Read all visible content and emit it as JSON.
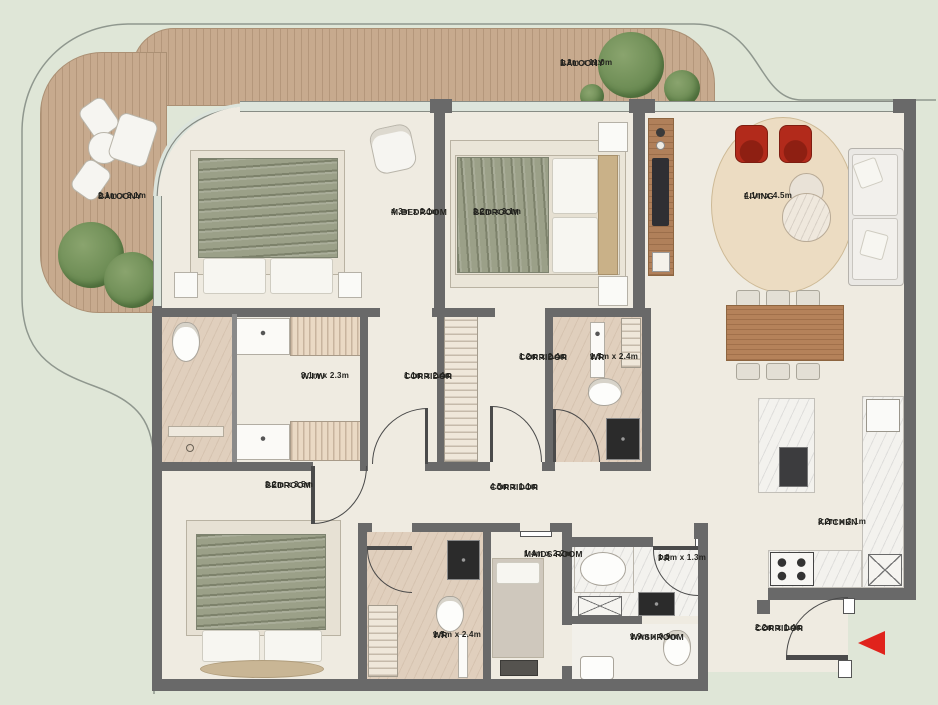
{
  "plan": {
    "colors": {
      "background": "#dfe6d7",
      "floor": "#efebe1",
      "wall": "#696969",
      "deck_wood": "#c7aa8e",
      "bed_olive": "#9ba088",
      "accent_chair_red": "#b22a1b",
      "entry_arrow_red": "#e0231c",
      "tree_green": "#6b8b53"
    },
    "entry": {
      "arrow_icon": "left-arrow",
      "meaning": "unit entrance"
    }
  },
  "rooms": [
    {
      "id": "balcony-left",
      "name": "BALCONY",
      "dims": "2.1m x 3.1m"
    },
    {
      "id": "balcony-top",
      "name": "BALCONY",
      "dims": "1.2m x 11.0m"
    },
    {
      "id": "m-bedroom",
      "name": "M.BEDROOM",
      "dims": "4.3m x 3.1m"
    },
    {
      "id": "bedroom-top",
      "name": "BEDROOM",
      "dims": "3.2m x 3.1m"
    },
    {
      "id": "living",
      "name": "LIVING",
      "dims": "4.1m x 4.5m"
    },
    {
      "id": "wiw",
      "name": "W.I.W",
      "dims": "3.1m x 2.3m"
    },
    {
      "id": "corridor-a",
      "name": "CORRIDOR",
      "dims": "1.1m x 2.4m"
    },
    {
      "id": "corridor-b",
      "name": "CORRIDOR",
      "dims": "1.2m x 2.4m"
    },
    {
      "id": "wr-top",
      "name": "WR",
      "dims": "1.5m x 2.4m"
    },
    {
      "id": "bedroom-bottom",
      "name": "BEDROOM",
      "dims": "3.2m x 3.5m"
    },
    {
      "id": "corridor-main",
      "name": "CORRIDOR",
      "dims": "4.5m x 1.1m"
    },
    {
      "id": "wr-bottom",
      "name": "WR",
      "dims": "1.5m x 2.4m"
    },
    {
      "id": "maids-room",
      "name": "MAIDS ROOM",
      "dims": "1.4m x 2.2m"
    },
    {
      "id": "pr",
      "name": "PR",
      "dims": "1.8m x 1.3m"
    },
    {
      "id": "washroom",
      "name": "WASHROOM",
      "dims": "1.9m x 0.9m"
    },
    {
      "id": "kitchen",
      "name": "KITCHEN",
      "dims": "3.2m x 3.1m"
    },
    {
      "id": "corridor-entry",
      "name": "CORRIDOR",
      "dims": "2.2m x 1.4m"
    }
  ]
}
